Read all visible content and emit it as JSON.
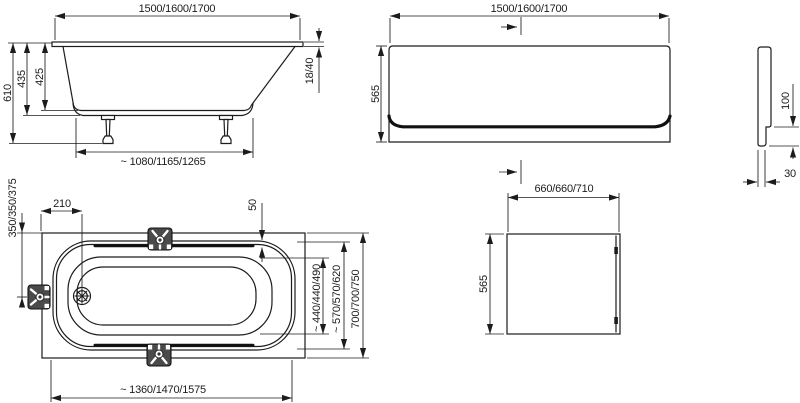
{
  "colors": {
    "line": "#1c1c1c",
    "bracket_fill": "#4a4a4a",
    "background": "#ffffff"
  },
  "side_view": {
    "length": "1500/1600/1700",
    "height_total": "610",
    "height_outer": "435",
    "height_inner": "425",
    "rim_thickness": "18/40",
    "bottom_length": "~ 1080/1165/1265"
  },
  "front_panel": {
    "width": "1500/1600/1700",
    "height": "565"
  },
  "profile": {
    "step_height": "100",
    "base_depth": "30"
  },
  "top_view": {
    "drain_from_end": "210",
    "drain_from_side": "350/350/375",
    "rim_offset": "50",
    "inner_width": "~ 440/440/490",
    "rim_width": "~ 570/570/620",
    "overall_width": "700/700/750",
    "inner_length": "~ 1360/1470/1575"
  },
  "end_panel": {
    "width": "660/660/710",
    "height": "565"
  }
}
